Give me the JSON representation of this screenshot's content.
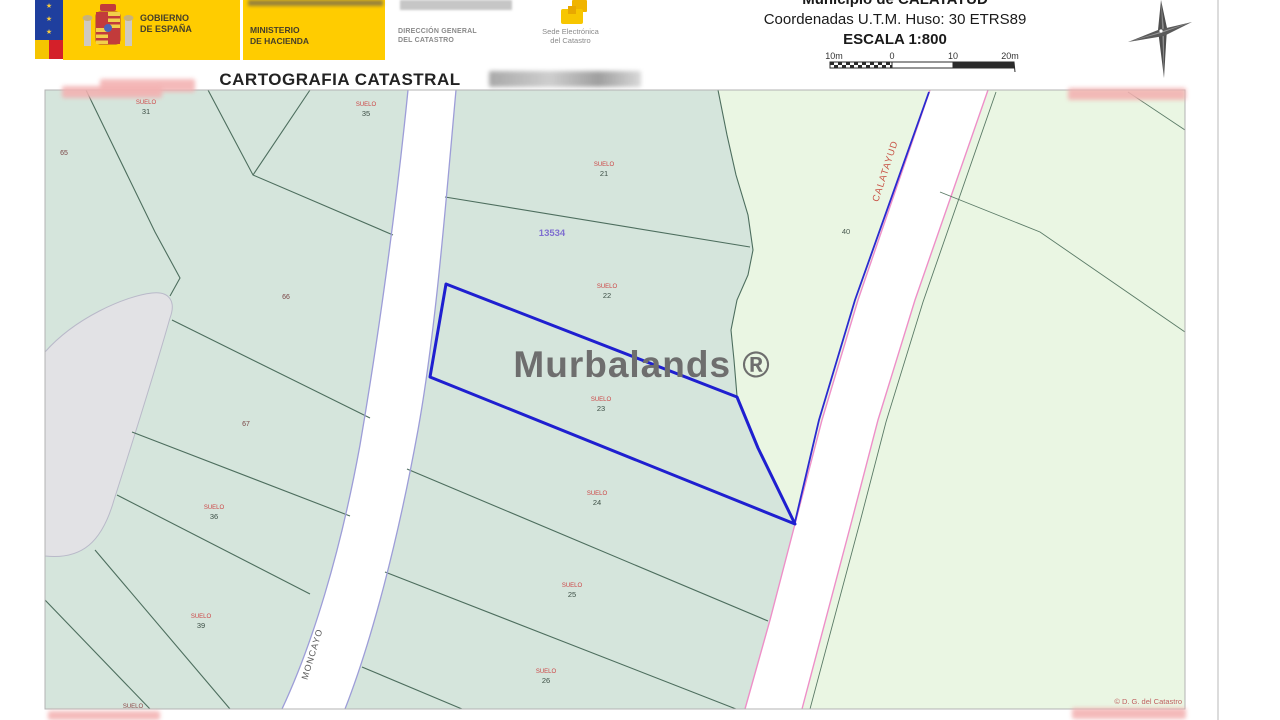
{
  "header": {
    "gobierno_line1": "GOBIERNO",
    "gobierno_line2": "DE ESPAÑA",
    "ministerio_line1": "MINISTERIO",
    "ministerio_line2": "DE HACIENDA",
    "dgc_line1": "DIRECCIÓN GENERAL",
    "dgc_line2": "DEL CATASTRO",
    "sede_line1": "Sede Electrónica",
    "sede_line2": "del Catastro",
    "municipio": "Municipio de CALATAYUD",
    "coordenadas": "Coordenadas U.T.M. Huso: 30 ETRS89",
    "escala": "ESCALA 1:800",
    "scalebar_labels": [
      "10m",
      "0",
      "10",
      "20m"
    ]
  },
  "title": "CARTOGRAFIA CATASTRAL",
  "map": {
    "polygon_number": "13534",
    "watermark": "Murbalands ®",
    "copyright": "© D. G. del Catastro",
    "streets": {
      "left": "MONCAYO",
      "right": "CALATAYUD"
    },
    "parcel_label_prefix": "SUELO",
    "parcels": {
      "p21": "21",
      "p22": "22",
      "p23": "23",
      "p24": "24",
      "p25": "25",
      "p26": "26",
      "p31": "31",
      "p35": "35",
      "p36": "36",
      "p39": "39"
    },
    "plots": {
      "n40": "40",
      "n65": "65",
      "n66": "66",
      "n67": "67"
    },
    "cut_label": "SUELO"
  },
  "colors": {
    "parcel_green": "#d5e5dc",
    "pale_green": "#eaf6e3",
    "gray_parcel": "#e2e2e5",
    "highlight_blue": "#1f1fd0",
    "road_pink": "#ee8fc8",
    "road_lavender": "#9d9dd8",
    "boundary_green": "#4d6e5e",
    "label_red": "#cc4444",
    "brand_yellow": "#ffcc00"
  }
}
